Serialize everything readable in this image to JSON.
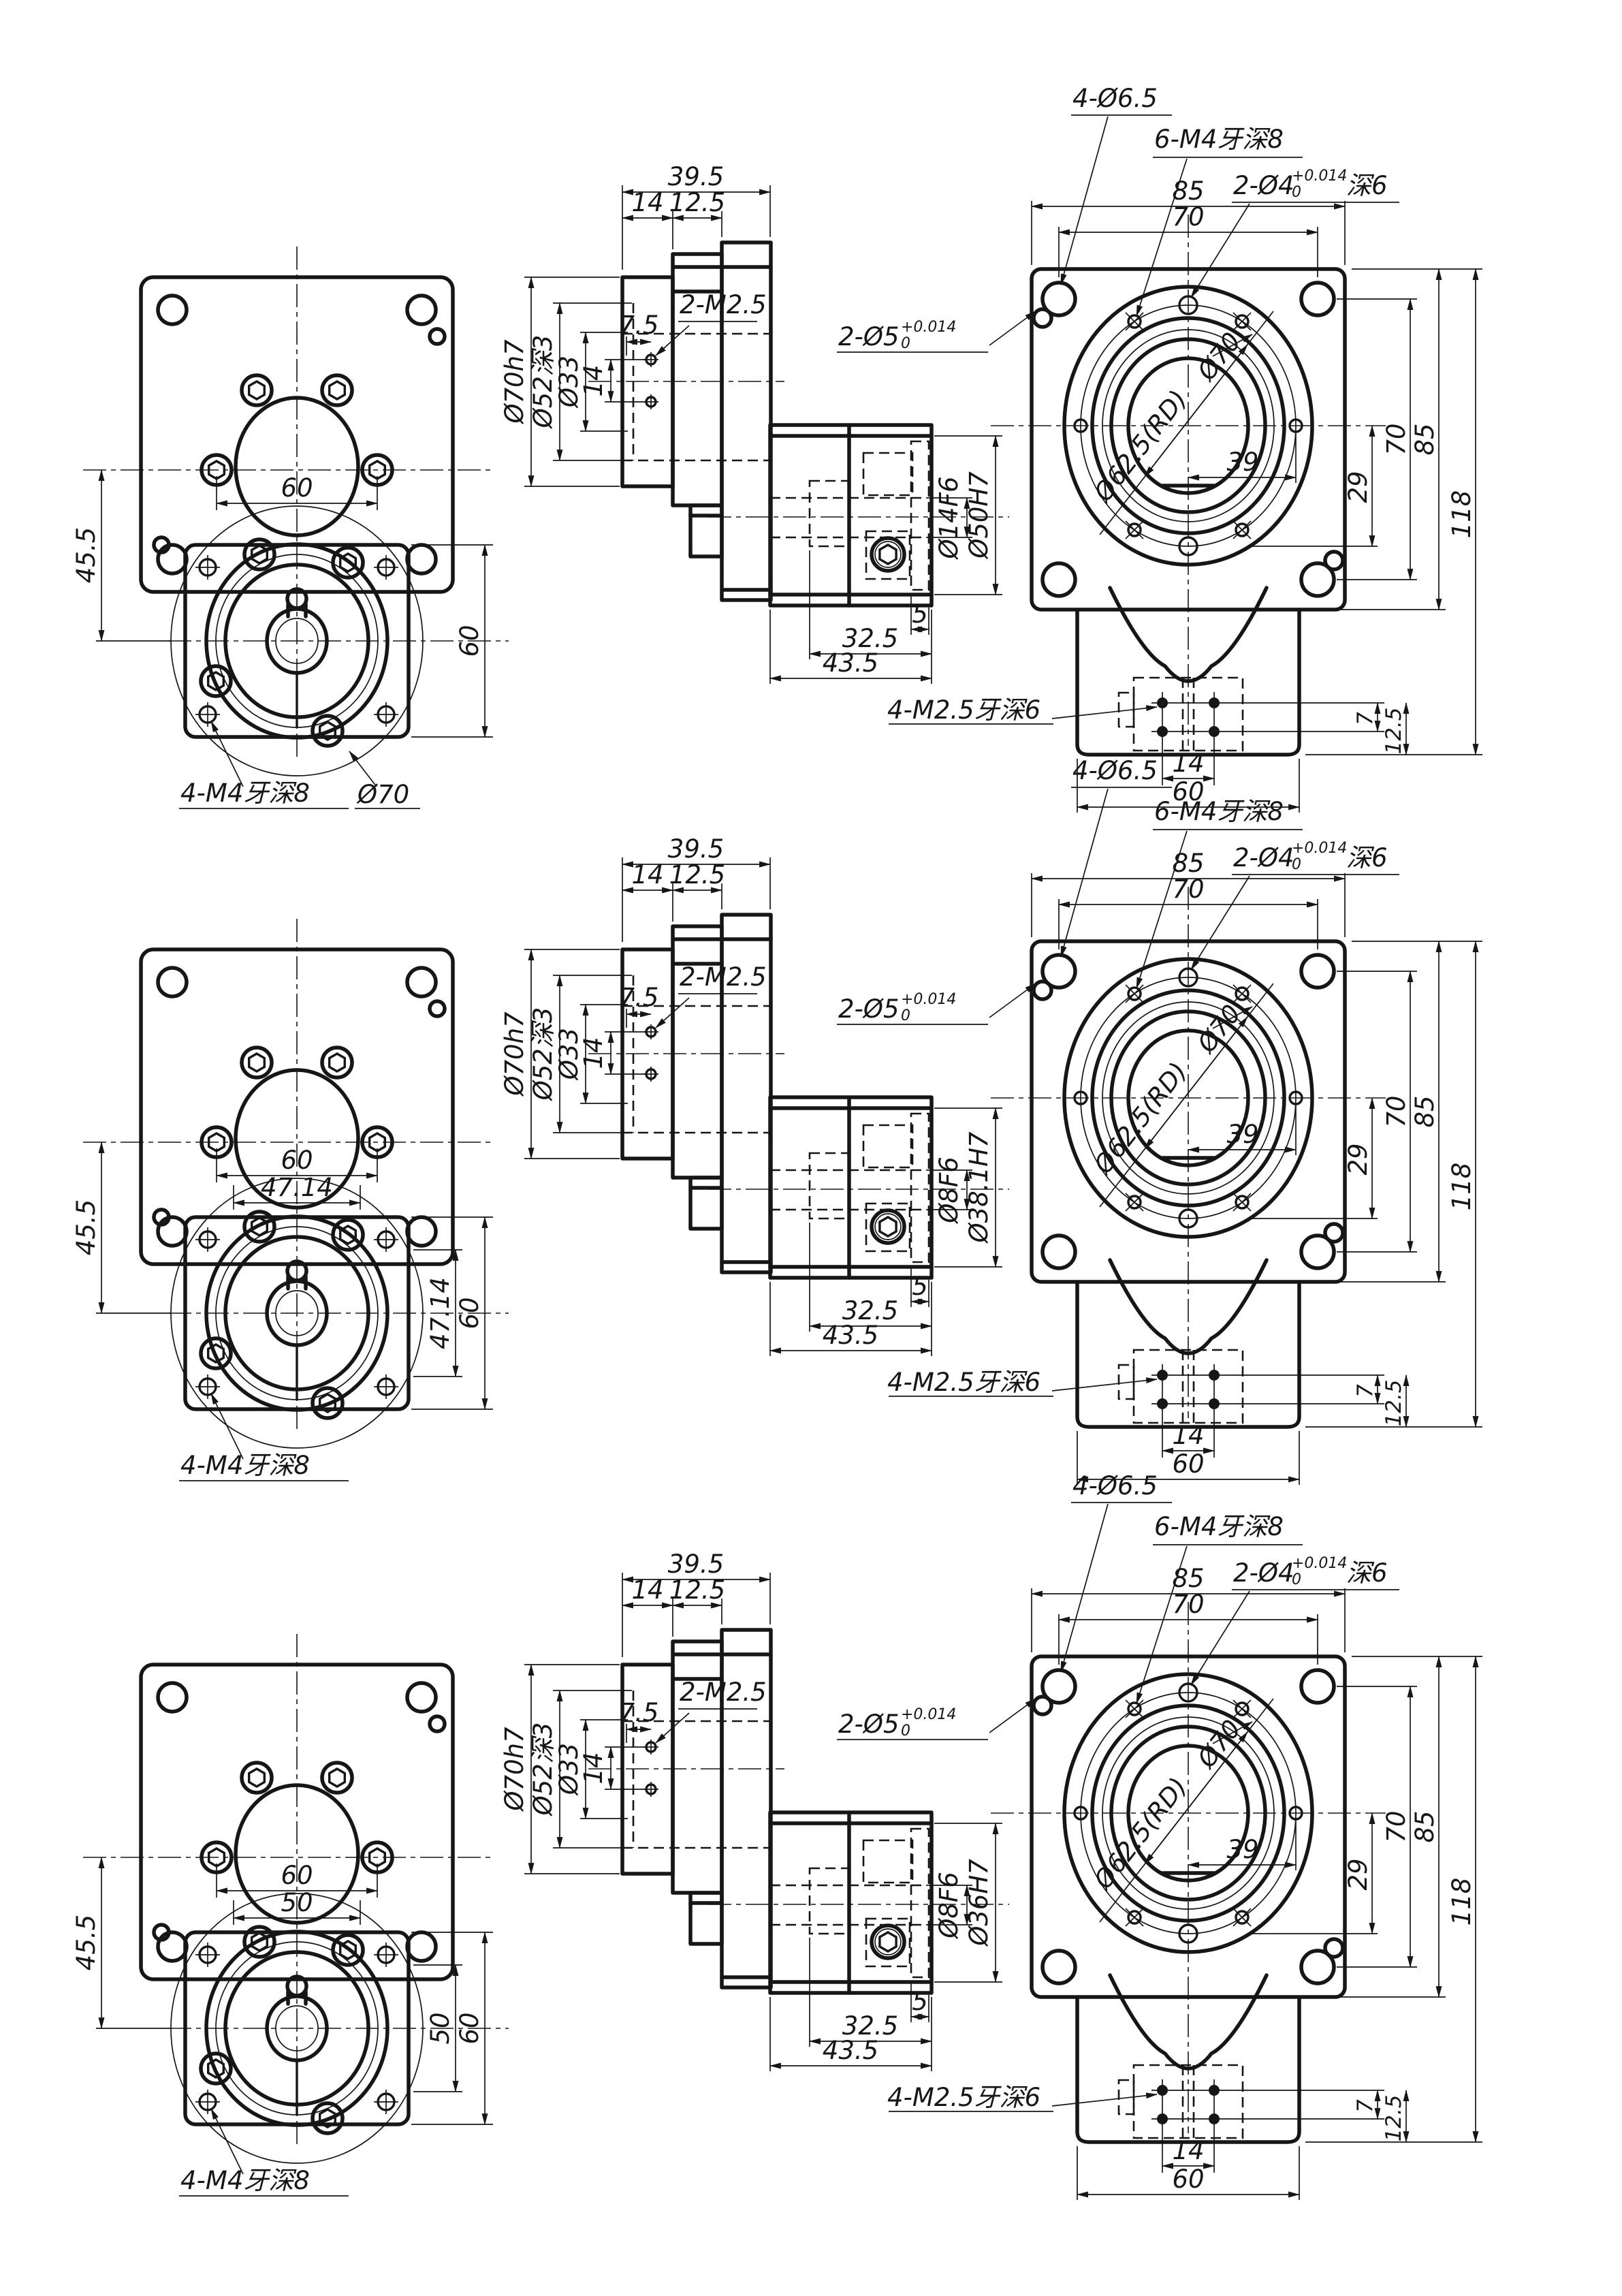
{
  "drawing": {
    "background": "#ffffff",
    "line_color": "#161616",
    "sheet": {
      "type": "mechanical-cad-drawing",
      "views_per_row": 3,
      "rows_count": 3
    },
    "rows": [
      {
        "left_view": {
          "dim_bolt_spacing": "60",
          "dim_vertical_left": "45.5",
          "dim_flange_height": "60",
          "thread_label": "4-M4牙深8",
          "pitch_circle_label": "Ø70"
        },
        "section_view": {
          "dim_total_width": "39.5",
          "dim_step1": "14",
          "dim_step2": "12.5",
          "dia_pilot": "Ø70h7",
          "dia_counterbore": "Ø52深3",
          "dia_bore": "Ø33",
          "dim_screw_span": "14",
          "dim_screw_offset": "7.5",
          "screw_label": "2-M2.5",
          "dia_shaft_bore": "Ø14F6",
          "dia_hub": "Ø50H7",
          "dim_key_offset": "5",
          "dim_key_width": "32.5",
          "dim_block_width": "43.5"
        },
        "right_view": {
          "label_corner_holes": "4-Ø6.5",
          "label_thread_holes": "6-M4牙深8",
          "label_pin4_prefix": "2-Ø4",
          "pin4_tol_upper": "+0.014",
          "pin4_tol_lower": "0",
          "label_pin4_suffix": "深6",
          "label_pin5_prefix": "2-Ø5",
          "pin5_tol_upper": "+0.014",
          "pin5_tol_lower": "0",
          "dim_width": "85",
          "dim_hole_pitch": "70",
          "label_bolt_circle": "Ø70",
          "label_register": "Ø62.5(RD)",
          "dim_39": "39",
          "dim_29": "29",
          "dim_pitch_v": "70",
          "dim_height": "85",
          "dim_total_height": "118",
          "label_bottom_threads": "4-M2.5牙深6",
          "dim_bottom_hole_spacing": "14",
          "dim_neck_width": "60",
          "dim_7": "7",
          "dim_12_5": "12.5"
        }
      },
      {
        "left_view": {
          "dim_bolt_spacing": "60",
          "dim_hex_spacing_h": "47.14",
          "dim_vertical_left": "45.5",
          "dim_hex_spacing_v": "47.14",
          "dim_flange_height": "60",
          "thread_label": "4-M4牙深8"
        },
        "section_view": {
          "dim_total_width": "39.5",
          "dim_step1": "14",
          "dim_step2": "12.5",
          "dia_pilot": "Ø70h7",
          "dia_counterbore": "Ø52深3",
          "dia_bore": "Ø33",
          "dim_screw_span": "14",
          "dim_screw_offset": "7.5",
          "screw_label": "2-M2.5",
          "dia_shaft_bore": "Ø8F6",
          "dia_hub": "Ø38.1H7",
          "dim_key_offset": "5",
          "dim_key_width": "32.5",
          "dim_block_width": "43.5"
        },
        "right_view": {
          "label_corner_holes": "4-Ø6.5",
          "label_thread_holes": "6-M4牙深8",
          "label_pin4_prefix": "2-Ø4",
          "pin4_tol_upper": "+0.014",
          "pin4_tol_lower": "0",
          "label_pin4_suffix": "深6",
          "label_pin5_prefix": "2-Ø5",
          "pin5_tol_upper": "+0.014",
          "pin5_tol_lower": "0",
          "dim_width": "85",
          "dim_hole_pitch": "70",
          "label_bolt_circle": "Ø70",
          "label_register": "Ø62.5(RD)",
          "dim_39": "39",
          "dim_29": "29",
          "dim_pitch_v": "70",
          "dim_height": "85",
          "dim_total_height": "118",
          "label_bottom_threads": "4-M2.5牙深6",
          "dim_bottom_hole_spacing": "14",
          "dim_neck_width": "60",
          "dim_7": "7",
          "dim_12_5": "12.5"
        }
      },
      {
        "left_view": {
          "dim_bolt_spacing": "60",
          "dim_hex_spacing_h": "50",
          "dim_vertical_left": "45.5",
          "dim_hex_spacing_v": "50",
          "dim_flange_height": "60",
          "thread_label": "4-M4牙深8"
        },
        "section_view": {
          "dim_total_width": "39.5",
          "dim_step1": "14",
          "dim_step2": "12.5",
          "dia_pilot": "Ø70h7",
          "dia_counterbore": "Ø52深3",
          "dia_bore": "Ø33",
          "dim_screw_span": "14",
          "dim_screw_offset": "7.5",
          "screw_label": "2-M2.5",
          "dia_shaft_bore": "Ø8F6",
          "dia_hub": "Ø36H7",
          "dim_key_offset": "5",
          "dim_key_width": "32.5",
          "dim_block_width": "43.5"
        },
        "right_view": {
          "label_corner_holes": "4-Ø6.5",
          "label_thread_holes": "6-M4牙深8",
          "label_pin4_prefix": "2-Ø4",
          "pin4_tol_upper": "+0.014",
          "pin4_tol_lower": "0",
          "label_pin4_suffix": "深6",
          "label_pin5_prefix": "2-Ø5",
          "pin5_tol_upper": "+0.014",
          "pin5_tol_lower": "0",
          "dim_width": "85",
          "dim_hole_pitch": "70",
          "label_bolt_circle": "Ø70",
          "label_register": "Ø62.5(RD)",
          "dim_39": "39",
          "dim_29": "29",
          "dim_pitch_v": "70",
          "dim_height": "85",
          "dim_total_height": "118",
          "label_bottom_threads": "4-M2.5牙深6",
          "dim_bottom_hole_spacing": "14",
          "dim_neck_width": "60",
          "dim_7": "7",
          "dim_12_5": "12.5"
        }
      }
    ]
  }
}
